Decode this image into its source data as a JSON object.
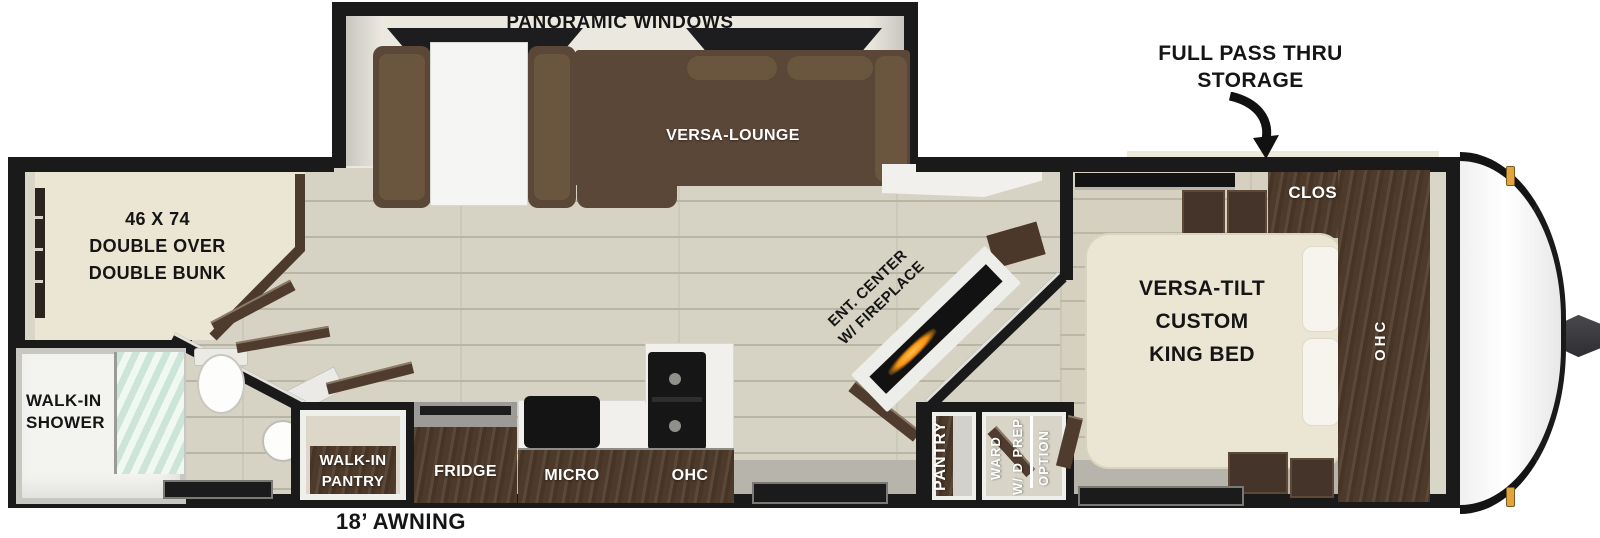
{
  "colors": {
    "wall": "#1a1a1a",
    "floor": "#d7d3c4",
    "floor_line": "#b9b5a6",
    "bedroom_floor": "#d5d0bf",
    "slide_interior": "#ebe8e0",
    "gray_floor": "#b7b4ab",
    "cabinet": "#4e3a2a",
    "sofa": "#5b4737",
    "sofa_light": "#6a553f",
    "cream": "#eae6d3",
    "white_surface": "#f1f0ec",
    "glass": "#cde5d9",
    "flame": "#f6930f",
    "amber": "#e2a43c",
    "trim": "#d9d5c7"
  },
  "exterior": {
    "windows_label": "PANORAMIC WINDOWS",
    "front_storage_line1": "FULL PASS THRU",
    "front_storage_line2": "STORAGE",
    "awning": "18’ AWNING"
  },
  "living": {
    "lounge": "VERSA-LOUNGE",
    "ent_center_line1": "ENT. CENTER",
    "ent_center_line2": "W/ FIREPLACE"
  },
  "bunk": {
    "line1": "46 X 74",
    "line2": "DOUBLE OVER",
    "line3": "DOUBLE BUNK"
  },
  "bath": {
    "shower_line1": "WALK-IN",
    "shower_line2": "SHOWER"
  },
  "kitchen": {
    "pantry_line1": "WALK-IN",
    "pantry_line2": "PANTRY",
    "fridge": "FRIDGE",
    "micro": "MICRO",
    "ohc": "OHC"
  },
  "closets": {
    "pantry": "PANTRY",
    "ward_line1": "WARD",
    "ward_line2": "W/ D PREP",
    "ward_line3": "OPTION"
  },
  "bedroom": {
    "bed_line1": "VERSA-TILT",
    "bed_line2": "CUSTOM",
    "bed_line3": "KING BED",
    "closet": "CLOSET",
    "ohc": "OHC"
  }
}
